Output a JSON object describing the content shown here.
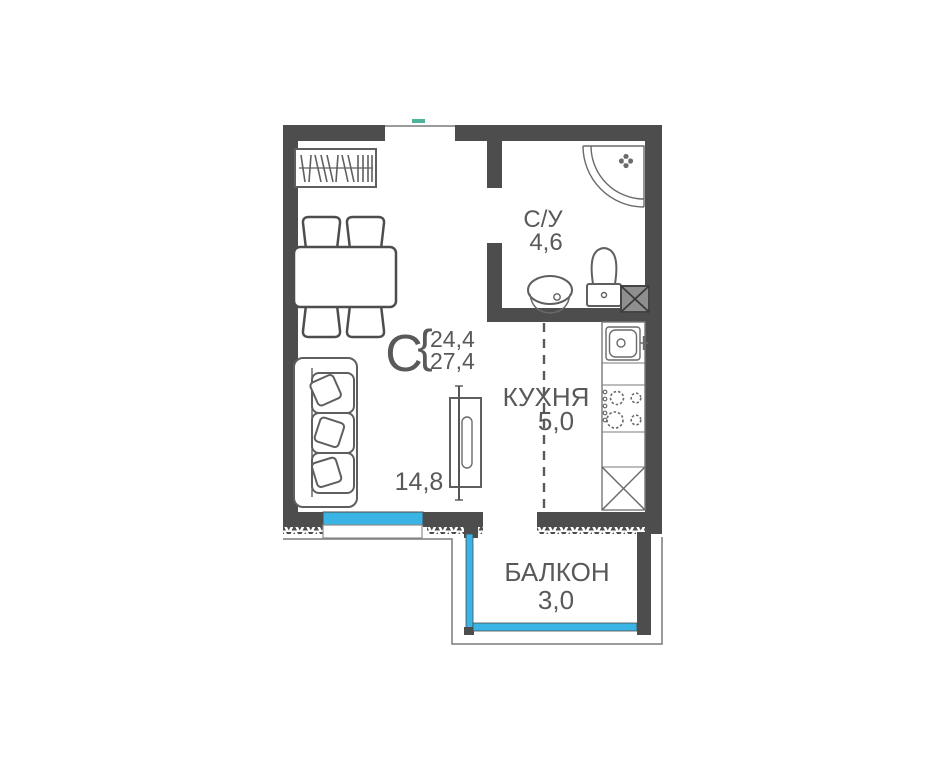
{
  "colors": {
    "wall_dark": "#4d4d4d",
    "window_blue": "#39b4e4",
    "type_letter_blue": "#4ab7db",
    "label_gray": "#58595b",
    "outline_gray": "#7a7a7a",
    "entrance_marker_green": "#4fb39b"
  },
  "unit": {
    "type_label": "С",
    "brace": "{",
    "area_living_total": "24,4",
    "area_with_balcony": "27,4"
  },
  "rooms": {
    "bathroom": {
      "name": "С/У",
      "area": "4,6"
    },
    "kitchen": {
      "name": "КУХНЯ",
      "area": "5,0"
    },
    "living": {
      "area": "14,8"
    },
    "balcony": {
      "name": "БАЛКОН",
      "area": "3,0"
    }
  }
}
